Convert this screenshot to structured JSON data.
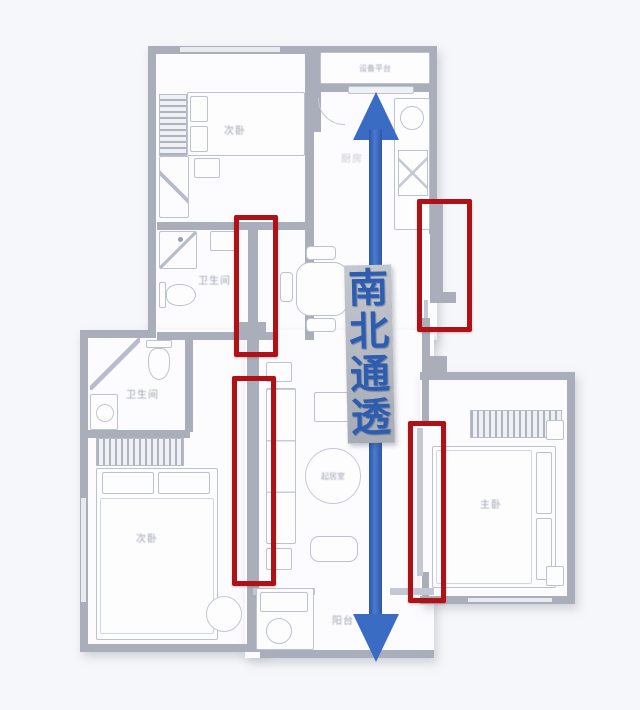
{
  "page": {
    "background": "#f6f7fa"
  },
  "annotation": {
    "direction_label": "南北通透",
    "direction_label_chars": [
      "南",
      "北",
      "通",
      "透"
    ],
    "arrow_color": "#3a6cc3",
    "arrow_dark": "#2d57a8",
    "ribbon_color": "#b6bac2",
    "text_color": "#2e5db0",
    "highlight_color": "#b01116",
    "highlight_count": 4
  },
  "plan": {
    "wall_color": "#a9aeba",
    "room_fill": "#fcfcfe",
    "labels": {
      "equipment_platform": "设备平台",
      "bedroom_top": "次卧",
      "kitchen": "厨房",
      "bathroom_mid": "卫生间",
      "bathroom_lower": "卫生间",
      "bedroom_left": "次卧",
      "living_room": "起居室",
      "bedroom_right": "主卧",
      "balcony": "阳台"
    }
  }
}
